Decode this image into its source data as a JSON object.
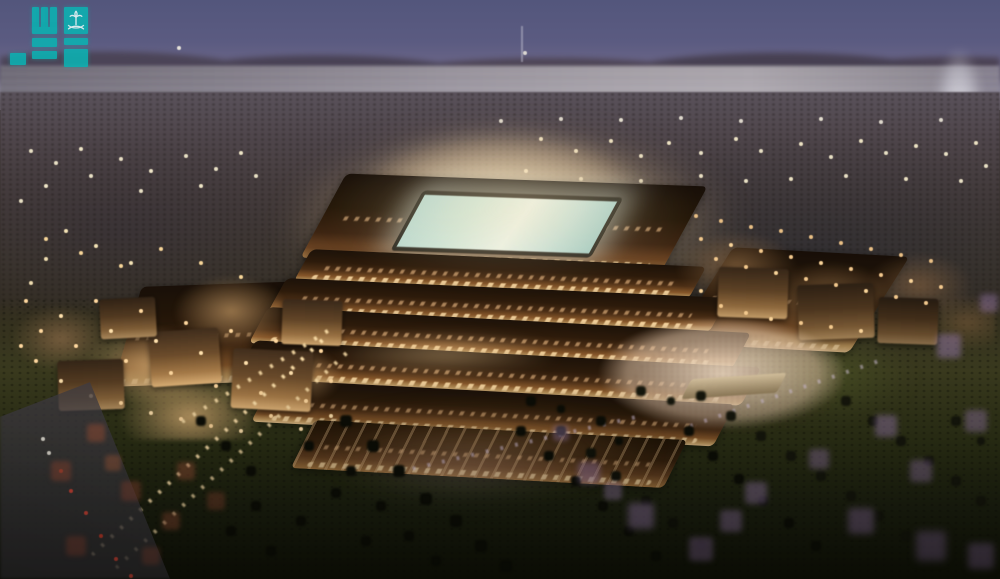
{
  "meta": {
    "type": "architectural-rendering-photograph",
    "subject": "Aerial dusk view of a large illuminated stadium and entertainment district with stepped amber-lit terraces around a glowing teal pitch, surrounded by village-style buildings, palm-dotted lawns, lavender blossom trees, a distant waterline and a tall fountain plume on the horizon"
  },
  "watermark": {
    "name": "Saudi Press Agency (SPA / واس) logo",
    "description": "Semi-transparent teal square-kufic block logo with white palm tree and crossed swords emblem, top-left corner",
    "color": "#10b1b2",
    "emblem_color": "#ecfdfd",
    "emblem": "palm-and-crossed-swords"
  },
  "palette": {
    "sky_top": "#53567b",
    "sky_horizon": "#948d9a",
    "water": "#aaa5ac",
    "hills": "#4a4354",
    "stadium_glow": "#f3dcae",
    "stadium_lit_edge": "#e7c492",
    "stadium_dark_roof": "#241709",
    "pitch": "#cfe6da",
    "village_walls": "#d6ae76",
    "window_lights": "#ffd9a2",
    "lawn": "#2d3117",
    "palm_silhouette": "#0c0d06",
    "blossom_trees": "#987aac",
    "red_trees": "#914a38",
    "path_lights": "#ffe3ae",
    "taillights": "#d4493c",
    "fountain_plume": "#eeeef4"
  }
}
